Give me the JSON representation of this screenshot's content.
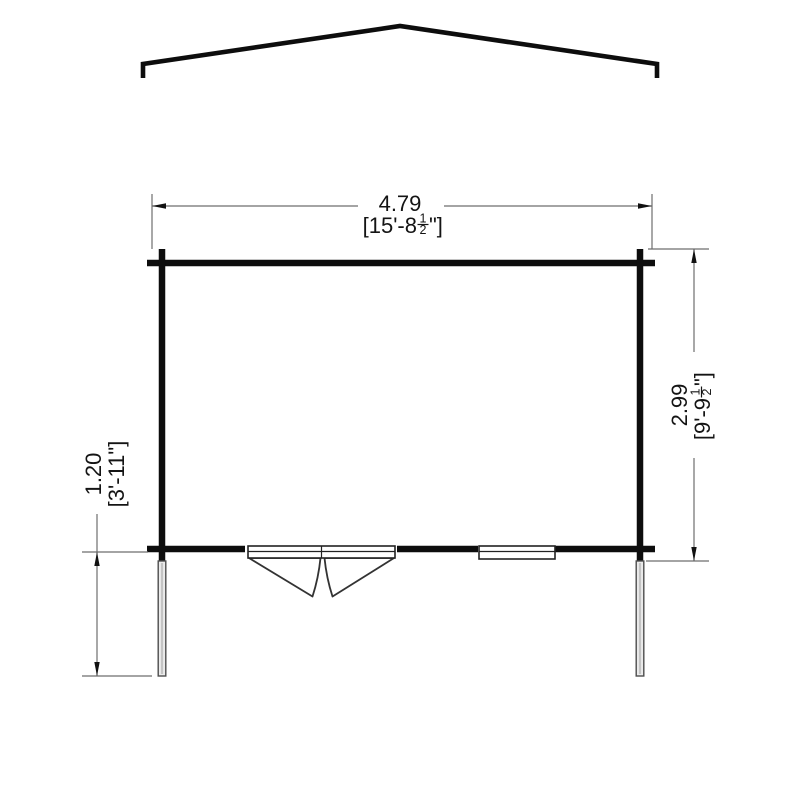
{
  "floorplan": {
    "width_dim": {
      "metric": "4.79",
      "imperial_pre": "[15'-8",
      "fraction_numerator": "1",
      "fraction_denominator": "2",
      "imperial_post": "\"]"
    },
    "depth_dim": {
      "metric": "2.99",
      "imperial_pre": "[9'-9",
      "fraction_numerator": "1",
      "fraction_denominator": "2",
      "imperial_post": "\"]"
    },
    "overhang_dim": {
      "metric": "1.20",
      "imperial": "[3'-11\"]"
    },
    "colors": {
      "wall": "#0d0d0d",
      "roof": "#0d0d0d",
      "dim_line": "#6e6e6e",
      "arrow": "#111111",
      "text": "#141414",
      "post_fill": "#ebebeb",
      "background": "#ffffff"
    }
  }
}
